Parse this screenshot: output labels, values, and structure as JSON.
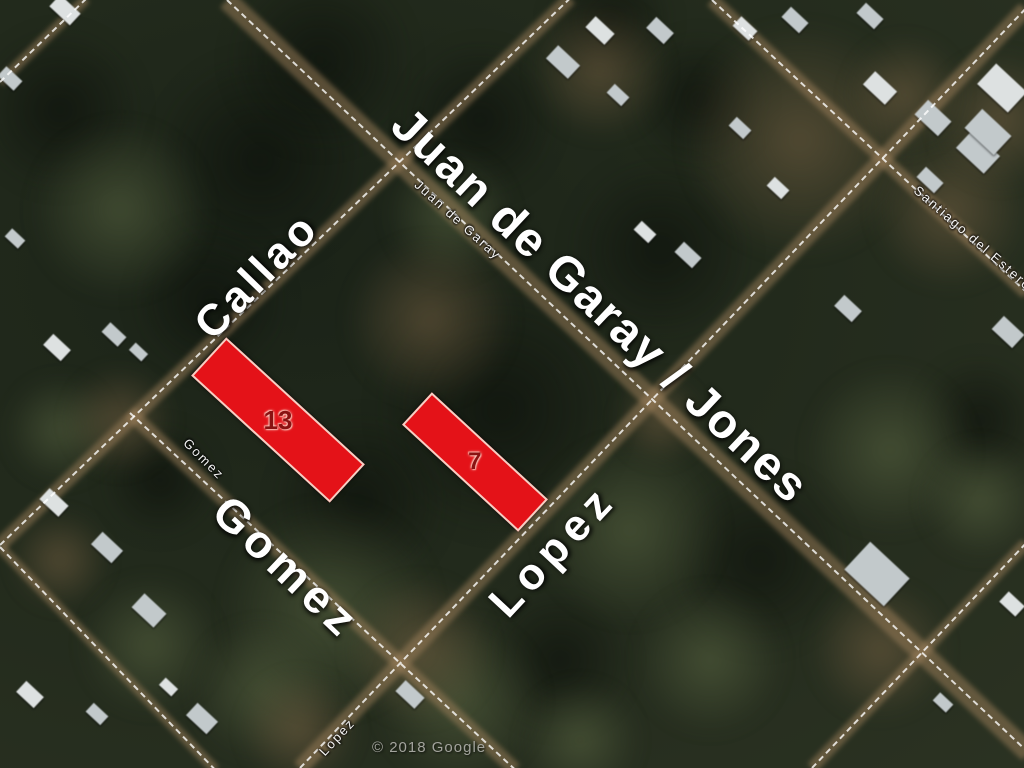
{
  "map": {
    "attribution": "© 2018 Google",
    "colors": {
      "parcel_fill": "#e41218",
      "parcel_border": "#f6cfc4",
      "parcel_text": "#8a1212",
      "label_text": "#ffffff",
      "attribution_text": "#a3a49d",
      "road_dash": "#ffffff",
      "dirt_band": "rgba(158,128,90,0.5)",
      "grass": "rgba(92,104,68,0.55)",
      "forest_dark": "rgba(10,14,9,0.62)",
      "dirt_patch": "rgba(128,104,72,0.5)",
      "house_light": "#dde1e1",
      "house_mid": "#c2c9cb"
    },
    "street_labels_large": [
      {
        "id": "callao",
        "text": "Callao",
        "x": 257,
        "y": 276,
        "rot": -46,
        "size": 44,
        "ls": 4
      },
      {
        "id": "juan-de-garay-jones",
        "text": "Juan de Garay / Jones",
        "x": 600,
        "y": 306,
        "rot": 43.2,
        "size": 48,
        "ls": 2
      },
      {
        "id": "gomez",
        "text": "Gomez",
        "x": 287,
        "y": 567,
        "rot": 43.5,
        "size": 46,
        "ls": 6
      },
      {
        "id": "lopez",
        "text": "Lopez",
        "x": 553,
        "y": 551,
        "rot": -47,
        "size": 44,
        "ls": 7
      }
    ],
    "street_labels_small": [
      {
        "id": "juan-de-garay",
        "text": "Juan de Garay",
        "x": 458,
        "y": 220,
        "rot": 42
      },
      {
        "id": "gomez",
        "text": "Gomez",
        "x": 204,
        "y": 459,
        "rot": 45
      },
      {
        "id": "santiago-del-estero",
        "text": "Santiago del Estero",
        "x": 973,
        "y": 238,
        "rot": 41
      },
      {
        "id": "lopez",
        "text": "Lopez",
        "x": 337,
        "y": 737,
        "rot": -47
      }
    ],
    "parcels": [
      {
        "label": "13",
        "cx": 278,
        "cy": 420,
        "w": 188,
        "h": 52,
        "rot": 42.5,
        "fontsize": 26
      },
      {
        "label": "7",
        "cx": 475,
        "cy": 462,
        "w": 158,
        "h": 44,
        "rot": 42.7,
        "fontsize": 24
      }
    ],
    "roads": [
      {
        "id": "juan-de-garay",
        "x": 227,
        "y": 0,
        "angle": 43.2,
        "len": 1100,
        "band": 20
      },
      {
        "id": "callao",
        "x": 0,
        "y": 545,
        "angle": -43.8,
        "len": 790,
        "band": 14
      },
      {
        "id": "lopez",
        "x": 300,
        "y": 768,
        "angle": -46.3,
        "len": 1050,
        "band": 16
      },
      {
        "id": "gomez",
        "x": 130,
        "y": 413,
        "angle": 42.8,
        "len": 525,
        "band": 14
      },
      {
        "id": "santiago-del-estero",
        "x": 712,
        "y": 0,
        "angle": 42.9,
        "len": 430,
        "band": 14
      },
      {
        "id": "sw-street",
        "x": 0,
        "y": 547,
        "angle": 46,
        "len": 310,
        "band": 10
      },
      {
        "id": "se-street",
        "x": 812,
        "y": 768,
        "angle": -46.4,
        "len": 310,
        "band": 12
      },
      {
        "id": "nw-street",
        "x": 0,
        "y": 82,
        "angle": -44,
        "len": 120,
        "band": 10
      }
    ],
    "forest_patches": [
      [
        260,
        160,
        110
      ],
      [
        500,
        410,
        130
      ],
      [
        660,
        250,
        95
      ],
      [
        360,
        500,
        90
      ],
      [
        60,
        110,
        85
      ],
      [
        760,
        560,
        95
      ],
      [
        560,
        660,
        75
      ],
      [
        210,
        300,
        80
      ],
      [
        320,
        60,
        95
      ],
      [
        610,
        20,
        65
      ],
      [
        980,
        420,
        65
      ],
      [
        480,
        120,
        80
      ],
      [
        160,
        480,
        60
      ],
      [
        700,
        100,
        70
      ]
    ],
    "grass_patches": [
      [
        120,
        210,
        90
      ],
      [
        450,
        215,
        65
      ],
      [
        330,
        610,
        110
      ],
      [
        460,
        700,
        85
      ],
      [
        630,
        530,
        95
      ],
      [
        890,
        450,
        85
      ],
      [
        150,
        645,
        70
      ],
      [
        710,
        660,
        75
      ],
      [
        60,
        430,
        55
      ],
      [
        980,
        500,
        60
      ],
      [
        260,
        690,
        70
      ],
      [
        580,
        740,
        60
      ]
    ],
    "dirt_patches": [
      [
        430,
        320,
        85
      ],
      [
        800,
        140,
        120
      ],
      [
        950,
        210,
        80
      ],
      [
        420,
        650,
        75
      ],
      [
        120,
        420,
        55
      ],
      [
        880,
        650,
        70
      ],
      [
        600,
        70,
        70
      ],
      [
        1000,
        120,
        70
      ],
      [
        300,
        730,
        60
      ],
      [
        905,
        95,
        60
      ],
      [
        660,
        420,
        45
      ],
      [
        60,
        560,
        50
      ]
    ],
    "houses": [
      [
        65,
        10,
        28,
        16
      ],
      [
        10,
        78,
        22,
        13
      ],
      [
        563,
        62,
        30,
        18
      ],
      [
        600,
        30,
        26,
        15
      ],
      [
        660,
        30,
        24,
        15
      ],
      [
        618,
        95,
        20,
        12
      ],
      [
        745,
        28,
        22,
        13
      ],
      [
        795,
        20,
        24,
        14
      ],
      [
        740,
        128,
        20,
        12
      ],
      [
        880,
        88,
        30,
        18
      ],
      [
        933,
        118,
        32,
        20
      ],
      [
        978,
        152,
        38,
        24
      ],
      [
        1002,
        88,
        42,
        28
      ],
      [
        988,
        132,
        40,
        26
      ],
      [
        870,
        16,
        24,
        14
      ],
      [
        778,
        188,
        20,
        12
      ],
      [
        848,
        308,
        24,
        15
      ],
      [
        1008,
        332,
        28,
        18
      ],
      [
        645,
        232,
        20,
        12
      ],
      [
        688,
        255,
        24,
        14
      ],
      [
        15,
        238,
        18,
        11
      ],
      [
        57,
        347,
        24,
        15
      ],
      [
        114,
        334,
        22,
        13
      ],
      [
        138,
        352,
        17,
        10
      ],
      [
        54,
        502,
        26,
        15
      ],
      [
        107,
        547,
        28,
        17
      ],
      [
        149,
        610,
        30,
        19
      ],
      [
        30,
        694,
        24,
        15
      ],
      [
        202,
        718,
        28,
        17
      ],
      [
        97,
        714,
        20,
        12
      ],
      [
        168,
        687,
        17,
        10
      ],
      [
        410,
        694,
        26,
        15
      ],
      [
        877,
        574,
        54,
        38
      ],
      [
        1012,
        604,
        22,
        14
      ],
      [
        943,
        702,
        18,
        11
      ],
      [
        930,
        180,
        24,
        14
      ]
    ]
  }
}
